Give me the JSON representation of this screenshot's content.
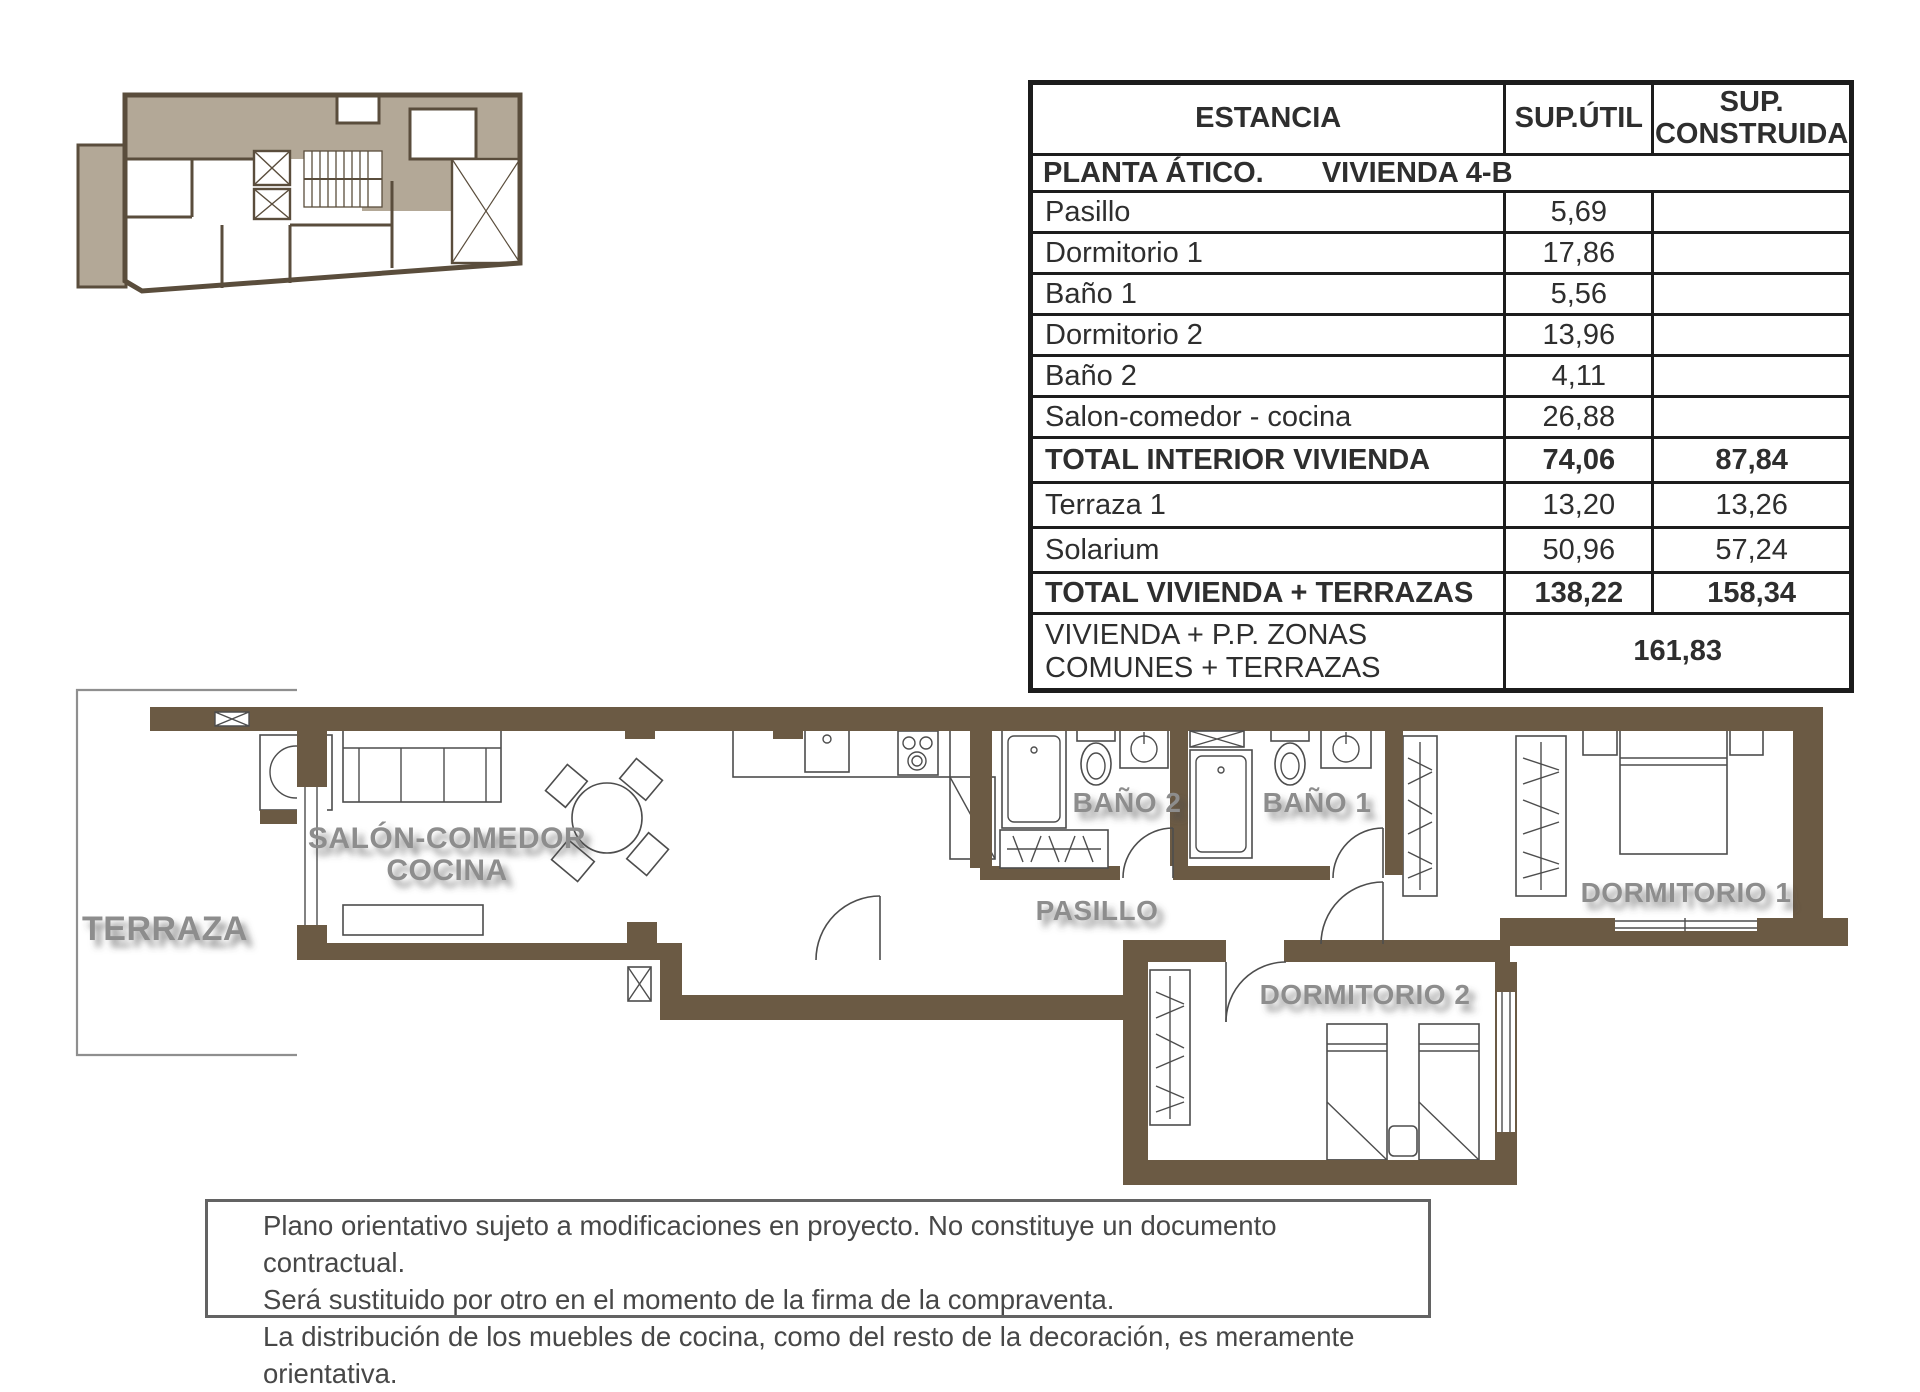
{
  "table": {
    "headers": {
      "estancia": "ESTANCIA",
      "sup_util": "SUP.ÚTIL",
      "sup_construida": "SUP. CONSTRUIDA"
    },
    "section_left": "PLANTA ÁTICO.",
    "section_right": "VIVIENDA 4-B",
    "rows": [
      {
        "label": "Pasillo",
        "util": "5,69",
        "construida": "",
        "bold": false
      },
      {
        "label": "Dormitorio 1",
        "util": "17,86",
        "construida": "",
        "bold": false
      },
      {
        "label": "Baño 1",
        "util": "5,56",
        "construida": "",
        "bold": false
      },
      {
        "label": "Dormitorio 2",
        "util": "13,96",
        "construida": "",
        "bold": false
      },
      {
        "label": "Baño 2",
        "util": "4,11",
        "construida": "",
        "bold": false
      },
      {
        "label": "Salon-comedor - cocina",
        "util": "26,88",
        "construida": "",
        "bold": false
      },
      {
        "label": "TOTAL INTERIOR VIVIENDA",
        "util": "74,06",
        "construida": "87,84",
        "bold": true
      },
      {
        "label": "Terraza 1",
        "util": "13,20",
        "construida": "13,26",
        "bold": false
      },
      {
        "label": "Solarium",
        "util": "50,96",
        "construida": "57,24",
        "bold": false
      },
      {
        "label": "TOTAL VIVIENDA + TERRAZAS",
        "util": "138,22",
        "construida": "158,34",
        "bold": true
      }
    ],
    "footer": {
      "label": "VIVIENDA + P.P. ZONAS COMUNES + TERRAZAS",
      "value": "161,83"
    }
  },
  "plan": {
    "terraza": "TERRAZA",
    "salon1": "SALÓN-COMEDOR",
    "salon2": "COCINA",
    "bano2": "BAÑO 2",
    "bano1": "BAÑO 1",
    "pasillo": "PASILLO",
    "dorm1": "DORMITORIO 1",
    "dorm2": "DORMITORIO 2"
  },
  "disclaimer": {
    "l1": "Plano orientativo sujeto a modificaciones en proyecto. No constituye un documento contractual.",
    "l2": "Será sustituido por otro en el momento de la firma de la compraventa.",
    "l3": "La distribución de los muebles de cocina, como del resto de la decoración, es meramente orientativa."
  },
  "colors": {
    "wall": "#6b5a44",
    "keyplan_highlight": "#b3a897",
    "keyplan_wall": "#5a4d3c",
    "room_label": "#8d8d8d",
    "table_border": "#1c1c1c"
  }
}
